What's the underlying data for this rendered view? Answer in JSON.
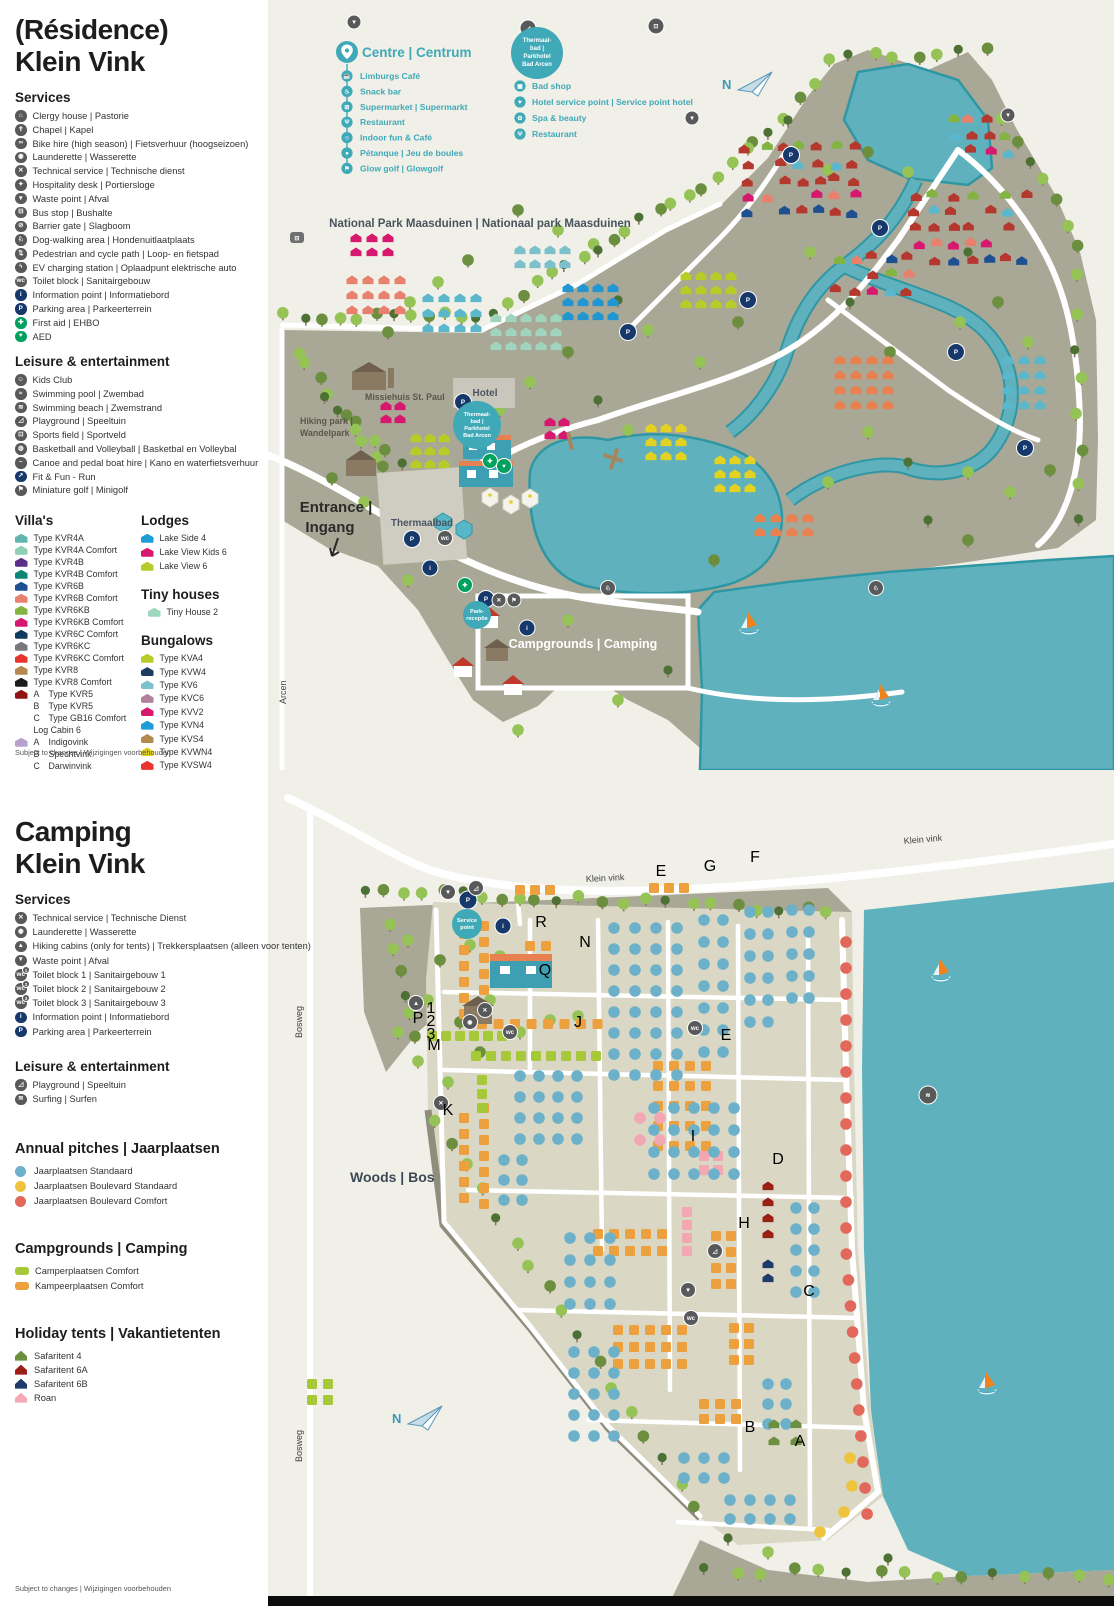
{
  "palette": {
    "cream": "#f0efe8",
    "land": "#a9a795",
    "land_light": "#dad8c5",
    "water": "#5fb2bd",
    "water_edge": "#2f97a4",
    "road": "#ffffff",
    "teal": "#3fa9b8",
    "navy": "#17386b",
    "green": "#00a15f",
    "gray_icon": "#58595b",
    "tree1": "#95c356",
    "tree2": "#4d7135",
    "tree3": "#6b8f3e",
    "trunk": "#8a7a5e",
    "pitch_blue": "#6cb1c9",
    "pitch_yellow": "#eec43f",
    "pitch_red": "#e2685c",
    "pitch_orange": "#eda13e",
    "pitch_green": "#a6c939",
    "pitch_pink": "#f2a7b3"
  },
  "residence": {
    "title1": "(Résidence)",
    "title2": "Klein Vink",
    "services_heading": "Services",
    "services": [
      {
        "icon": "clergy-house",
        "glyph": "⌂",
        "label": "Clergy house | Pastorie"
      },
      {
        "icon": "chapel",
        "glyph": "✝",
        "label": "Chapel | Kapel"
      },
      {
        "icon": "bike-hire",
        "glyph": "∞",
        "label": "Bike hire (high season) | Fietsverhuur (hoogseizoen)"
      },
      {
        "icon": "launderette",
        "glyph": "◉",
        "label": "Launderette | Wasserette"
      },
      {
        "icon": "technical-service",
        "glyph": "✕",
        "label": "Technical service | Technische dienst"
      },
      {
        "icon": "hospitality-desk",
        "glyph": "✦",
        "label": "Hospitality desk | Portiersloge"
      },
      {
        "icon": "waste-point",
        "glyph": "▼",
        "label": "Waste point | Afval"
      },
      {
        "icon": "bus-stop",
        "glyph": "⊟",
        "label": "Bus stop | Bushalte"
      },
      {
        "icon": "barrier-gate",
        "glyph": "⊘",
        "label": "Barrier gate | Slagboom"
      },
      {
        "icon": "dog-walking-area",
        "glyph": "♘",
        "label": "Dog-walking area | Hondenuitlaatplaats"
      },
      {
        "icon": "pedestrian-cycle-path",
        "glyph": "⇅",
        "label": "Pedestrian and cycle path | Loop- en fietspad"
      },
      {
        "icon": "ev-charging-station",
        "glyph": "ϟ",
        "label": "EV charging station | Oplaadpunt elektrische auto"
      },
      {
        "icon": "toilet-block",
        "glyph": "wc",
        "label": "Toilet block | Sanitairgebouw"
      },
      {
        "icon": "information-point",
        "glyph": "i",
        "color": "#17386b",
        "label": "Information point | Informatiebord"
      },
      {
        "icon": "parking-area",
        "glyph": "P",
        "color": "#17386b",
        "label": "Parking area | Parkeerterrein"
      },
      {
        "icon": "first-aid",
        "glyph": "✚",
        "color": "#00a15f",
        "label": "First aid | EHBO"
      },
      {
        "icon": "aed",
        "glyph": "♥",
        "color": "#00a15f",
        "label": "AED"
      }
    ],
    "leisure_heading": "Leisure & entertainment",
    "leisure": [
      {
        "icon": "kids-club",
        "glyph": "☺",
        "label": "Kids Club"
      },
      {
        "icon": "swimming-pool",
        "glyph": "≈",
        "label": "Swimming pool | Zwembad"
      },
      {
        "icon": "swimming-beach",
        "glyph": "≋",
        "label": "Swimming beach | Zwemstrand"
      },
      {
        "icon": "playground",
        "glyph": "◿",
        "label": "Playground | Speeltuin"
      },
      {
        "icon": "sports-field",
        "glyph": "⊡",
        "label": "Sports field | Sportveld"
      },
      {
        "icon": "basketball-volleyball",
        "glyph": "◍",
        "label": "Basketball and Volleyball | Basketbal en Volleybal"
      },
      {
        "icon": "canoe-pedal-boat-hire",
        "glyph": "~",
        "label": "Canoe and pedal boat hire | Kano en waterfietsverhuur"
      },
      {
        "icon": "fit-fun-run",
        "glyph": "➚",
        "color": "#17386b",
        "label": "Fit & Fun - Run"
      },
      {
        "icon": "miniature-golf",
        "glyph": "⚑",
        "label": "Miniature golf | Minigolf"
      }
    ],
    "villas_heading": "Villa's",
    "villas": [
      {
        "color": "#62b5ad",
        "label": "Type KVR4A"
      },
      {
        "color": "#8ed0b4",
        "label": "Type KVR4A Comfort"
      },
      {
        "color": "#5c2e85",
        "label": "Type KVR4B"
      },
      {
        "color": "#0d8577",
        "label": "Type KVR4B Comfort"
      },
      {
        "color": "#1d4f91",
        "label": "Type KVR6B"
      },
      {
        "color": "#e8806d",
        "label": "Type KVR6B Comfort"
      },
      {
        "color": "#83b441",
        "label": "Type KVR6KB"
      },
      {
        "color": "#d6196e",
        "label": "Type KVR6KB Comfort"
      },
      {
        "color": "#123a5e",
        "label": "Type KVR6C Comfort"
      },
      {
        "color": "#77787b",
        "label": "Type KVR6KC"
      },
      {
        "color": "#e8342c",
        "label": "Type KVR6KC Comfort"
      },
      {
        "color": "#b3894d",
        "label": "Type KVR8"
      },
      {
        "color": "#1c1c1c",
        "label": "Type KVR8 Comfort"
      },
      {
        "color": "#901414",
        "sub": "A",
        "label": "Type KVR5"
      },
      {
        "sub": "B",
        "label": "Type KVR5"
      },
      {
        "sub": "C",
        "label": "Type GB16 Comfort"
      },
      {
        "label": "Log Cabin 6"
      },
      {
        "color": "#b79fd0",
        "sub": "A",
        "label": "Indigovink"
      },
      {
        "sub": "B",
        "label": "Spechtvink"
      },
      {
        "sub": "C",
        "label": "Darwinvink"
      },
      {
        "sub": "D",
        "label": "Mangrovevinkvz"
      }
    ],
    "lodges_heading": "Lodges",
    "lodges": [
      {
        "color": "#1e9cd7",
        "label": "Lake Side 4"
      },
      {
        "color": "#d6196e",
        "label": "Lake View Kids 6"
      },
      {
        "color": "#b8cc27",
        "label": "Lake View 6"
      }
    ],
    "tiny_heading": "Tiny houses",
    "tiny": [
      {
        "color": "#9cd6bb",
        "label": "Tiny House 2"
      }
    ],
    "bungalows_heading": "Bungalows",
    "bungalows": [
      {
        "color": "#b8cc27",
        "label": "Type KVA4"
      },
      {
        "color": "#1d3a5f",
        "label": "Type KVW4"
      },
      {
        "color": "#7cc0cc",
        "label": "Type KV6"
      },
      {
        "color": "#b2809c",
        "label": "Type KVC6"
      },
      {
        "color": "#d6196e",
        "label": "Type KVV2"
      },
      {
        "color": "#1e9cd7",
        "label": "Type KVN4"
      },
      {
        "color": "#b3894d",
        "label": "Type KVS4"
      },
      {
        "color": "#e3d222",
        "label": "Type KVWN4"
      },
      {
        "color": "#e8342c",
        "label": "Type KVSW4"
      },
      {
        "color": "#1c1c1c",
        "label": "Type KV10"
      }
    ],
    "footer": "Subject to changes | Wijzigingen voorbehouden",
    "map": {
      "centre": {
        "heading": "Centre | Centrum",
        "items": [
          {
            "icon": "limburgs-cafe",
            "glyph": "☕",
            "label": "Limburgs Café"
          },
          {
            "icon": "snack-bar",
            "glyph": "♨",
            "label": "Snack bar"
          },
          {
            "icon": "supermarket",
            "glyph": "⊞",
            "label": "Supermarket | Supermarkt"
          },
          {
            "icon": "restaurant",
            "glyph": "Ψ",
            "label": "Restaurant"
          },
          {
            "icon": "indoor-fun-cafe",
            "glyph": "☺",
            "label": "Indoor fun & Café"
          },
          {
            "icon": "petanque",
            "glyph": "●",
            "label": "Pétanque | Jeu de boules"
          },
          {
            "icon": "glow-golf",
            "glyph": "⚑",
            "label": "Glow golf | Glowgolf"
          }
        ]
      },
      "thermal": {
        "circle_lines": [
          "Thermaal-",
          "bad |",
          "Parkhotel",
          "Bad Arcen"
        ],
        "items": [
          {
            "icon": "bad-shop",
            "glyph": "▣",
            "label": "Bad shop"
          },
          {
            "icon": "hotel-service-point",
            "glyph": "✦",
            "label": "Hotel service point | Service point hotel"
          },
          {
            "icon": "spa-beauty",
            "glyph": "✿",
            "label": "Spa & beauty"
          },
          {
            "icon": "thermal-restaurant",
            "glyph": "Ψ",
            "label": "Restaurant"
          }
        ]
      },
      "labels": {
        "national_park": "National Park Maasduinen | Nationaal park Maasduinen",
        "missiehuis": "Missiehuis St. Paul",
        "hiking1": "Hiking park |",
        "hiking2": "Wandelpark",
        "hotel": "Hotel",
        "thermaalbad": "Thermaalbad",
        "entrance1": "Entrance |",
        "entrance2": "Ingang",
        "campgrounds": "Campgrounds | Camping",
        "arcen": "Arcen",
        "north": "N",
        "park_receptie_1": "Park-",
        "park_receptie_2": "receptie"
      }
    }
  },
  "camping": {
    "title1": "Camping",
    "title2": "Klein Vink",
    "services_heading": "Services",
    "services": [
      {
        "icon": "technical-service",
        "glyph": "✕",
        "label": "Technical service | Technische Dienst"
      },
      {
        "icon": "launderette",
        "glyph": "◉",
        "label": "Launderette | Wasserette"
      },
      {
        "icon": "hiking-cabins",
        "glyph": "▲",
        "label": "Hiking cabins (only for tents) | Trekkersplaatsen (alleen voor tenten)"
      },
      {
        "icon": "waste-point",
        "glyph": "▼",
        "label": "Waste point | Afval"
      },
      {
        "icon": "toilet-block-1",
        "glyph": "wc",
        "badge": "1",
        "label": "Toilet block 1 | Sanitairgebouw 1"
      },
      {
        "icon": "toilet-block-2",
        "glyph": "wc",
        "badge": "2",
        "label": "Toilet block 2 | Sanitairgebouw 2"
      },
      {
        "icon": "toilet-block-3",
        "glyph": "wc",
        "badge": "3",
        "label": "Toilet block 3 | Sanitairgebouw 3"
      },
      {
        "icon": "information-point",
        "glyph": "i",
        "color": "#17386b",
        "label": "Information point | Informatiebord"
      },
      {
        "icon": "parking-area",
        "glyph": "P",
        "color": "#17386b",
        "label": "Parking area | Parkeerterrein"
      }
    ],
    "leisure_heading": "Leisure & entertainment",
    "leisure": [
      {
        "icon": "playground",
        "glyph": "◿",
        "label": "Playground | Speeltuin"
      },
      {
        "icon": "surfing",
        "glyph": "≋",
        "label": "Surfing | Surfen"
      }
    ],
    "annual_heading": "Annual pitches | Jaarplaatsen",
    "annual": [
      {
        "color": "#6cb1c9",
        "label": "Jaarplaatsen Standaard"
      },
      {
        "color": "#eec43f",
        "label": "Jaarplaatsen Boulevard Standaard"
      },
      {
        "color": "#e2685c",
        "label": "Jaarplaatsen Boulevard Comfort"
      }
    ],
    "campgrounds_heading": "Campgrounds | Camping",
    "campgrounds": [
      {
        "color": "#a6c939",
        "label": "Camperplaatsen Comfort"
      },
      {
        "color": "#eda13e",
        "label": "Kampeerplaatsen Comfort"
      }
    ],
    "tents_heading": "Holiday tents | Vakantietenten",
    "tents": [
      {
        "color": "#6d9040",
        "label": "Safaritent 4"
      },
      {
        "color": "#9c1f15",
        "label": "Safaritent 6A"
      },
      {
        "color": "#1d3a6b",
        "label": "Safaritent 6B"
      },
      {
        "color": "#f4aab6",
        "label": "Roan"
      }
    ],
    "footer": "Subject to changes | Wijzigingen voorbehouden",
    "map": {
      "labels": {
        "klein_vink": "Klein vink",
        "woods": "Woods | Bos",
        "bosweg": "Bosweg",
        "north": "N",
        "service_point_1": "Service",
        "service_point_2": "point"
      },
      "sections": [
        {
          "label": "E",
          "x": 393,
          "y": 106
        },
        {
          "label": "G",
          "x": 442,
          "y": 101
        },
        {
          "label": "F",
          "x": 487,
          "y": 92
        },
        {
          "label": "R",
          "x": 273,
          "y": 157
        },
        {
          "label": "N",
          "x": 317,
          "y": 177
        },
        {
          "label": "Q",
          "x": 277,
          "y": 205
        },
        {
          "label": "J",
          "x": 310,
          "y": 257
        },
        {
          "label": "M",
          "x": 166,
          "y": 280
        },
        {
          "label": "P",
          "x": 150,
          "y": 253
        },
        {
          "label": "1",
          "x": 163,
          "y": 243,
          "small": true
        },
        {
          "label": "2",
          "x": 163,
          "y": 256,
          "small": true
        },
        {
          "label": "3",
          "x": 163,
          "y": 269,
          "small": true
        },
        {
          "label": "K",
          "x": 180,
          "y": 345
        },
        {
          "label": "I",
          "x": 425,
          "y": 371
        },
        {
          "label": "E",
          "x": 458,
          "y": 270
        },
        {
          "label": "D",
          "x": 510,
          "y": 394
        },
        {
          "label": "H",
          "x": 476,
          "y": 458
        },
        {
          "label": "C",
          "x": 541,
          "y": 526
        },
        {
          "label": "B",
          "x": 482,
          "y": 662
        },
        {
          "label": "A",
          "x": 532,
          "y": 676
        }
      ]
    }
  }
}
